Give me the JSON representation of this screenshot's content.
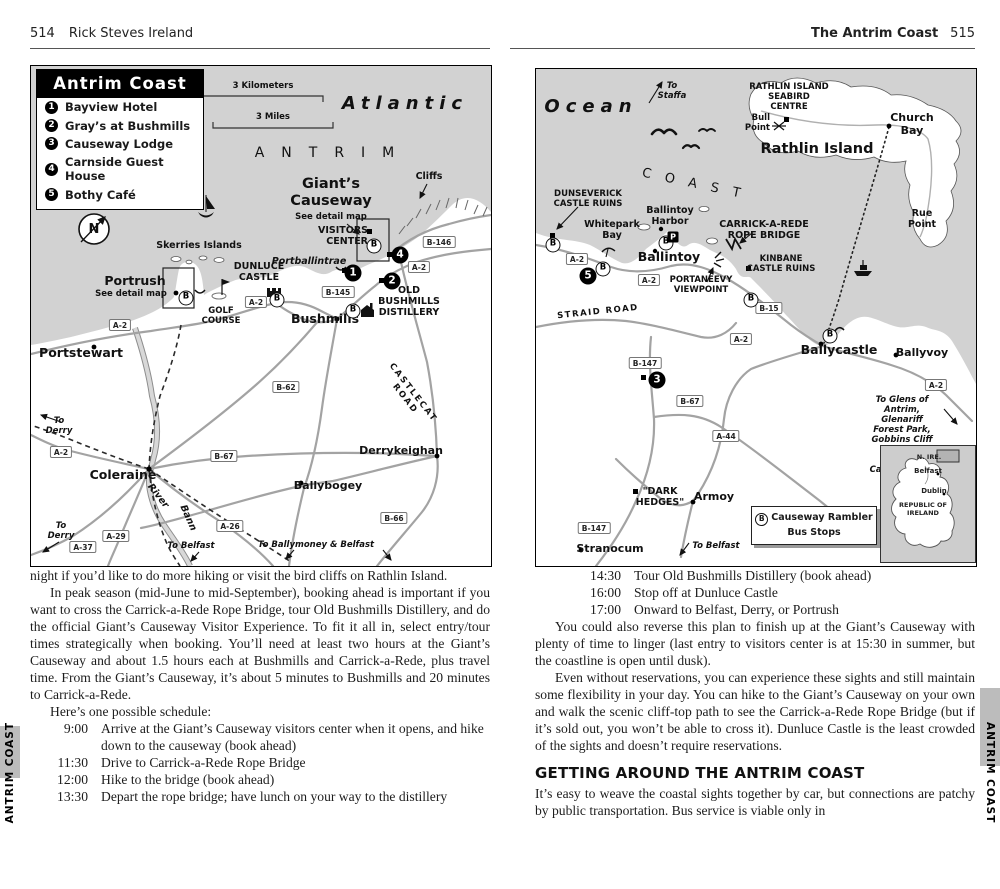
{
  "side_tabs": {
    "left": "ANTRIM COAST",
    "right": "ANTRIM COAST"
  },
  "left_page": {
    "header": {
      "page": "514",
      "title": "Rick Steves Ireland"
    },
    "map": {
      "legend_title": "Antrim Coast",
      "legend_items": [
        {
          "num": "1",
          "label": "Bayview Hotel"
        },
        {
          "num": "2",
          "label": "Gray’s at Bushmills"
        },
        {
          "num": "3",
          "label": "Causeway Lodge"
        },
        {
          "num": "4",
          "label": "Carnside Guest House"
        },
        {
          "num": "5",
          "label": "Bothy Café"
        }
      ],
      "scale_km": "3 Kilometers",
      "scale_mi": "3 Miles",
      "bus": "B",
      "markers": {
        "m1": "1",
        "m2": "2",
        "m4": "4"
      },
      "roads": {
        "a2": "A-2",
        "a26": "A-26",
        "a29": "A-29",
        "a37": "A-37",
        "b145": "B-145",
        "b146": "B-146",
        "b62": "B-62",
        "b66": "B-66",
        "b67": "B-67"
      },
      "labels": {
        "compass_n": "N",
        "atlantic": "Atlantic",
        "antrim": "ANTRIM",
        "giants_causeway": "Giant’s\nCauseway",
        "see_detail_map": "See detail map",
        "cliffs": "Cliffs",
        "visitors_center": "VISITORS\nCENTER",
        "portballintrae": "Portballintrae",
        "old_bushmills": "OLD\nBUSHMILLS\nDISTILLERY",
        "bushmills": "Bushmills",
        "dunluce": "DUNLUCE\nCASTLE",
        "skerries": "Skerries Islands",
        "portrush": "Portrush",
        "golf_course": "GOLF\nCOURSE",
        "portstewart": "Portstewart",
        "to_derry": "To\nDerry",
        "coleraine": "Coleraine",
        "river": "River",
        "bann": "Bann",
        "derrykeighan": "Derrykeighan",
        "ballybogey": "Ballybogey",
        "castlecat": "CASTLECAT ROAD",
        "to_belfast": "To Belfast",
        "to_ballymoney": "To Ballymoney & Belfast"
      }
    },
    "body": {
      "p1": "night if you’d like to do more hiking or visit the bird cliffs on Rathlin Island.",
      "p2": "In peak season (mid-June to mid-September), booking ahead is important if you want to cross the Carrick-a-Rede Rope Bridge, tour Old Bushmills Distillery, and do the official Giant’s Causeway Visitor Experience. To fit it all in, select entry/tour times strategically when booking. You’ll need at least two hours at the Giant’s Causeway and about 1.5 hours each at Bushmills and Carrick-a-Rede, plus travel time. From the Giant’s Causeway, it’s about 5 minutes to Bushmills and 20 minutes to Carrick-a-Rede.",
      "p3": "Here’s one possible schedule:",
      "schedule": [
        {
          "time": "9:00",
          "text": "Arrive at the Giant’s Causeway visitors center when it opens, and hike down to the causeway (book ahead)"
        },
        {
          "time": "11:30",
          "text": "Drive to Carrick-a-Rede Rope Bridge"
        },
        {
          "time": "12:00",
          "text": "Hike to the bridge (book ahead)"
        },
        {
          "time": "13:30",
          "text": "Depart the rope bridge; have lunch on your way to the distillery"
        }
      ]
    }
  },
  "right_page": {
    "header": {
      "title": "The Antrim Coast",
      "page": "515"
    },
    "map": {
      "bus": "B",
      "markers": {
        "m3": "3",
        "m5": "5"
      },
      "roads": {
        "a2": "A-2",
        "a44": "A-44",
        "b15": "B-15",
        "b67": "B-67",
        "b147": "B-147"
      },
      "labels": {
        "ocean": "Ocean",
        "to_staffa": "To\nStaffa",
        "coast": "COAST",
        "seabird": "RATHLIN ISLAND\nSEABIRD\nCENTRE",
        "bull_point": "Bull\nPoint",
        "church_bay": "Church Bay",
        "rathlin": "Rathlin Island",
        "rue_point": "Rue\nPoint",
        "dunseverick": "DUNSEVERICK\nCASTLE RUINS",
        "whitepark": "Whitepark\nBay",
        "ballintoy_harbor": "Ballintoy\nHarbor",
        "ballintoy": "Ballintoy",
        "carrick": "CARRICK-A-REDE\nROPE BRIDGE",
        "kinbane": "KINBANE\nCASTLE RUINS",
        "portaneevy": "PORTANEEVY\nVIEWPOINT",
        "straid": "STRAID ROAD",
        "ballycastle": "Ballycastle",
        "ballyvoy": "Ballyvoy",
        "to_glens": "To Glens of Antrim,\nGlenariff Forest Park,\nGobbins Cliff Path\n& Carrickfergus Castle",
        "dark_hedges": "\"DARK\nHEDGES\"",
        "armoy": "Armoy",
        "stranocum": "Stranocum",
        "to_belfast": "To Belfast",
        "parking": "P"
      },
      "bus_legend": {
        "b": "B",
        "line1": "Causeway Rambler",
        "line2": "Bus Stops"
      },
      "inset": {
        "n_ire": "N. IRE.",
        "belfast": "Belfast",
        "dublin": "Dublin",
        "republic": "REPUBLIC OF\nIRELAND"
      }
    },
    "body": {
      "schedule": [
        {
          "time": "14:30",
          "text": "Tour Old Bushmills Distillery (book ahead)"
        },
        {
          "time": "16:00",
          "text": "Stop off at Dunluce Castle"
        },
        {
          "time": "17:00",
          "text": "Onward to Belfast, Derry, or Portrush"
        }
      ],
      "p1": "You could also reverse this plan to finish up at the Giant’s Causeway with plenty of time to linger (last entry to visitors center is at 15:30 in summer, but the coastline is open until dusk).",
      "p2": "Even without reservations, you can experience these sights and still maintain some flexibility in your day. You can hike to the Giant’s Causeway on your own and walk the scenic cliff-top path to see the Carrick-a-Rede Rope Bridge (but if it’s sold out, you won’t be able to cross it). Dunluce Castle is the least crowded of the sights and doesn’t require reservations.",
      "heading": "GETTING AROUND THE ANTRIM COAST",
      "p3": "It’s easy to weave the coastal sights together by car, but connections are patchy by public transportation. Bus service is viable only in"
    }
  }
}
